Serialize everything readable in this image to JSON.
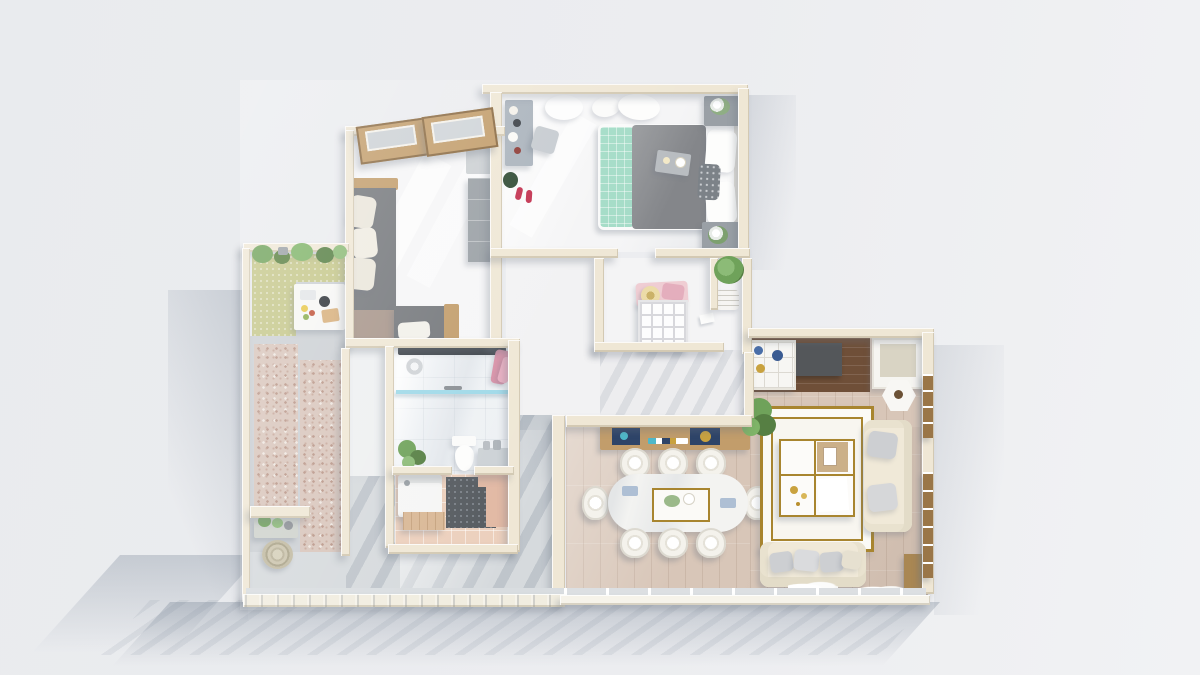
{
  "meta": {
    "scene": "top-down-3d-apartment-floor-plan-render",
    "canvas_width_px": 1200,
    "canvas_height_px": 675,
    "visible_text": "none"
  },
  "palette": {
    "wall": "#efe7d5",
    "wallLight": "#f9f6ee",
    "wallShade": "#ddd3bd",
    "floorWhite": "#f5f5f6",
    "floorWood": "#d8c6b8",
    "rug": "#f8f6f0",
    "gold": "#a8852f",
    "tvWood": "#6f4f38",
    "woodTrim": "#c29d6b",
    "bedGray": "#8b8d91",
    "mint": "#a4dcc7",
    "sofaGray": "#75787c",
    "sofaCream": "#f0e9d8",
    "pillowGray": "#cdcfd2",
    "oliveMat": "#c5c78a",
    "pebble": "#d9c6bc",
    "pathGray": "#ccd0d4",
    "terrace": "#d6dadd",
    "marbleTile": "#eef1f4",
    "peach": "#ecd0bd",
    "darkTile": "#575c61",
    "glassBlue": "#9fd9e8",
    "towelPink": "#d892a8",
    "plantGreen": "#6fa25a",
    "plantDark": "#567f43",
    "navy": "#2e4468",
    "shadow": "rgba(110,122,140,0.30)"
  },
  "rooms": [
    {
      "id": "master-bedroom",
      "contents": [
        "double-bed",
        "mint-quilt",
        "gray-duvet",
        "pillows",
        "breakfast-tray",
        "nightstand-with-plant-top",
        "nightstand-with-plant-bottom",
        "vanity-desk",
        "stool",
        "red-slippers",
        "dark-plant",
        "sheer-curtains"
      ]
    },
    {
      "id": "second-bedroom",
      "contents": [
        "l-shaped-gray-daybed",
        "cream-pillows",
        "wood-trim",
        "single-bed",
        "white-pillow",
        "gray-cabinet",
        "gray-wardrobe",
        "tilted-wood-windows"
      ]
    },
    {
      "id": "balcony",
      "contents": [
        "planter-row",
        "olive-green-mat",
        "picnic-table-with-food",
        "pebble-strips",
        "stone-path",
        "plant-stand",
        "round-woven-mat"
      ]
    },
    {
      "id": "bathroom",
      "contents": [
        "shower-bar",
        "shower-head",
        "pink-towels",
        "glass-screen",
        "toilet",
        "vanity-sink",
        "green-plant"
      ]
    },
    {
      "id": "laundry-room",
      "contents": [
        "washing-machine",
        "dark-dotted-tile-pad",
        "wood-counter",
        "peach-tiles"
      ]
    },
    {
      "id": "walk-in-closet",
      "contents": [
        "grid-shelf-unit",
        "blush-clothes-pile",
        "sun-hat",
        "potted-plant",
        "laundry-basket"
      ]
    },
    {
      "id": "hallway",
      "contents": []
    },
    {
      "id": "living-dining-room",
      "contents": [
        "sideboard-console",
        "navy-drawer-decor",
        "marble-dining-table",
        "gold-centerpiece-tray",
        "dining-chairs-x8",
        "tv-wood-panel",
        "tv",
        "display-cabinet",
        "side-armchair-cabinet",
        "hexagon-side-table",
        "green-tree-plant",
        "gold-border-rug",
        "grid-coffee-table",
        "cream-sofa-right",
        "cream-sofa-bottom",
        "white-coral-decor",
        "window-wall"
      ]
    }
  ]
}
